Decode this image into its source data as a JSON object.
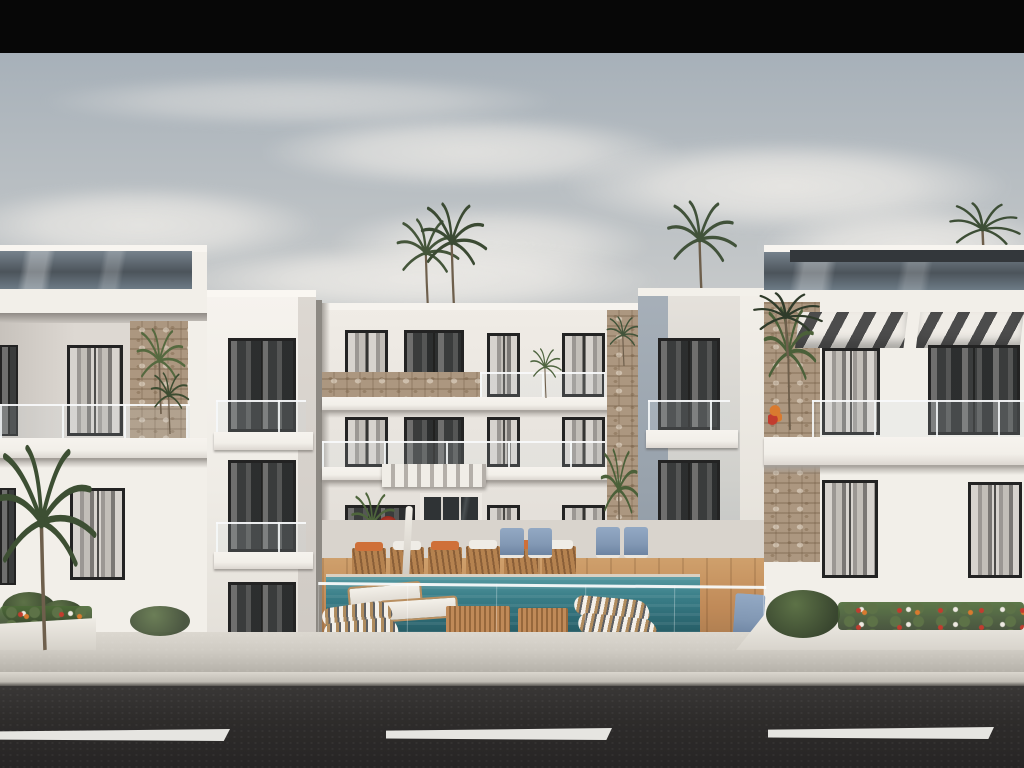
{
  "scene": {
    "type": "architectural-exterior-rendering",
    "description": "Daytime rendering of a modern white three-storey apartment complex: two side wings and a recessed centre block joined by two white tower columns, a central courtyard with teal swimming pool, wooden deck, sun loungers, striped awnings on the right wing, rooftop palm trees, a frameless glass balustrade above a concrete sidewalk, and an asphalt road with dashed white lane markings in the foreground, letterboxed with a black bar at the top"
  },
  "counts": {
    "visible_floors_center_block": 3,
    "tall_background_palms": 4,
    "road_lane_dashes": 3,
    "striped_awnings": 2
  },
  "colors": {
    "letterbox": "#070707",
    "sky_top": "#a0abb5",
    "sky_mid": "#c6c9ca",
    "sky_horizon": "#ddd9d3",
    "cloud": "#eceae6",
    "wall_light": "#f2efe9",
    "wall_mid": "#e2ded8",
    "wall_shadow": "#b4b0ab",
    "tower_shadow": "#98a2ac",
    "glass_band": "#59626b",
    "window_glass": "#35383a",
    "window_frame": "#232323",
    "curtain": "#d7d3ce",
    "stone": "#ac9780",
    "awning_base": "#efece6",
    "awning_stripe": "#4c4c4c",
    "pool_deep": "#2e6b75",
    "pool_light": "#5598a0",
    "deck_wood": "#c08a58",
    "lounger_cushion": "#cf7039",
    "chair_blue": "#8298b4",
    "palm_dark": "#39462f",
    "palm_light": "#5d7247",
    "balustrade_tint": "rgba(205,220,224,0.28)",
    "sidewalk": "#cfcbc3",
    "road": "#2e2c2b",
    "road_marking": "#e6e5e1",
    "planter_green": "#4d6b38",
    "flower_red": "#c23c2e",
    "flower_orange": "#d97a2f",
    "flower_white": "#eeeae2"
  }
}
